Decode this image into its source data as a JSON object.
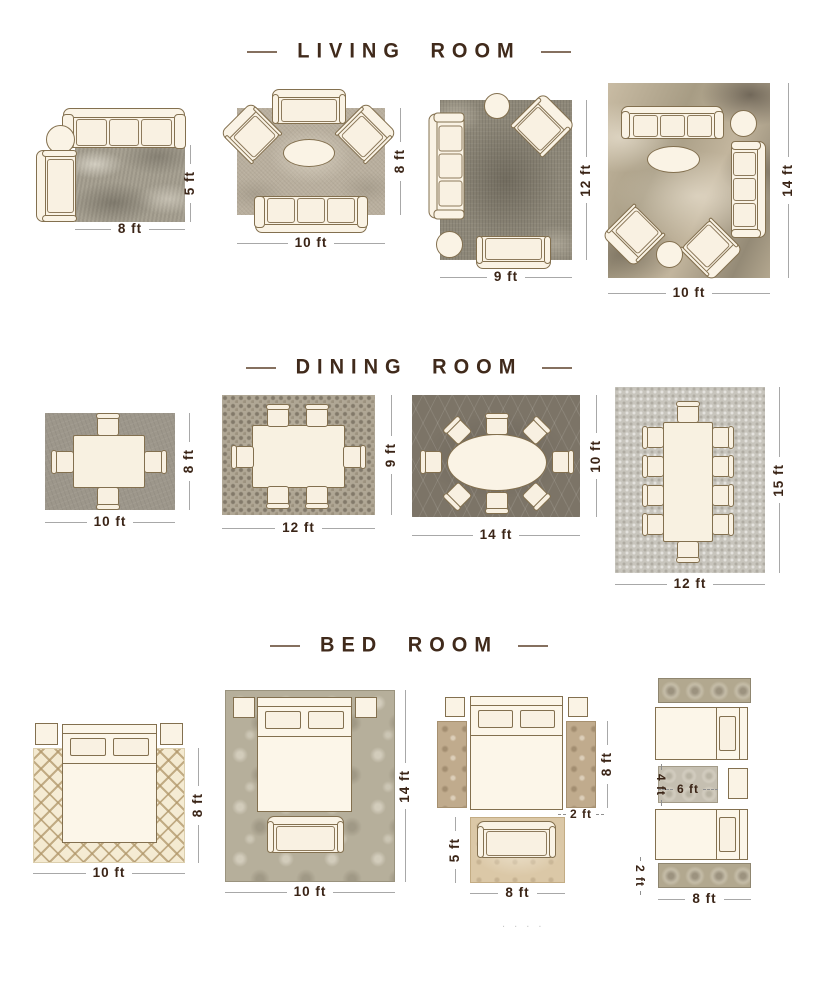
{
  "document": {
    "type": "rug-size-guide-infographic",
    "background": "#ffffff",
    "footer_dots": ". . . ."
  },
  "colors": {
    "title_text": "#402a1b",
    "title_dash": "#85705f",
    "dimension_text": "#3a2416",
    "dimension_line": "#a8a8a8",
    "furniture_fill": "#faf3e5",
    "furniture_outline": "#83704f"
  },
  "sections": [
    {
      "title": "LIVING ROOM",
      "layouts": [
        {
          "rug": "mottled gray rug",
          "width": "8 ft",
          "height": "5 ft",
          "furniture": [
            "sofa",
            "armchair",
            "round side table"
          ]
        },
        {
          "rug": "textured beige rug",
          "width": "10 ft",
          "height": "8 ft",
          "furniture": [
            "loveseat",
            "accent chair left",
            "accent chair right",
            "oval coffee table",
            "sofa"
          ]
        },
        {
          "rug": "distressed gray rug",
          "width": "9 ft",
          "height": "12 ft",
          "furniture": [
            "round side table",
            "accent chair",
            "sofa",
            "ottoman",
            "loveseat"
          ]
        },
        {
          "rug": "abstract beige-brown rug",
          "width": "10 ft",
          "height": "14 ft",
          "furniture": [
            "sofa top",
            "round side table",
            "sofa right",
            "oval coffee table",
            "accent chair left",
            "accent chair right",
            "ottoman"
          ]
        }
      ]
    },
    {
      "title": "DINING ROOM",
      "layouts": [
        {
          "rug": "gray rug",
          "width": "10 ft",
          "height": "8 ft",
          "furniture": [
            "dining table",
            "4 chairs"
          ]
        },
        {
          "rug": "mosaic rug",
          "width": "12 ft",
          "height": "9 ft",
          "furniture": [
            "dining table",
            "6 chairs"
          ]
        },
        {
          "rug": "dark trellis rug",
          "width": "14 ft",
          "height": "10 ft",
          "furniture": [
            "oval dining table",
            "8 chairs"
          ]
        },
        {
          "rug": "light gray rug",
          "width": "12 ft",
          "height": "15 ft",
          "furniture": [
            "long dining table",
            "10 chairs"
          ]
        }
      ]
    },
    {
      "title": "BED ROOM",
      "layouts": [
        {
          "rug": "cream lattice rug",
          "width": "10 ft",
          "height": "8 ft",
          "furniture": [
            "queen bed",
            "nightstand left",
            "nightstand right"
          ]
        },
        {
          "rug": "damask rug",
          "width": "10 ft",
          "height": "14 ft",
          "furniture": [
            "queen bed",
            "nightstand left",
            "nightstand right",
            "bench"
          ]
        },
        {
          "rug": "two side runners and foot rug",
          "runner_height": "8 ft",
          "runner_width": "2 ft",
          "foot_rug_height": "5 ft",
          "foot_rug_width": "8 ft",
          "furniture": [
            "queen bed",
            "nightstand left",
            "nightstand right",
            "bench"
          ]
        },
        {
          "rug": "twin-bed runners and center rug",
          "middle_rug_width": "6 ft",
          "middle_rug_height": "4 ft",
          "runner_width": "2 ft",
          "runner_length": "8 ft",
          "furniture": [
            "twin bed top",
            "twin bed bottom",
            "nightstand"
          ]
        }
      ]
    }
  ]
}
